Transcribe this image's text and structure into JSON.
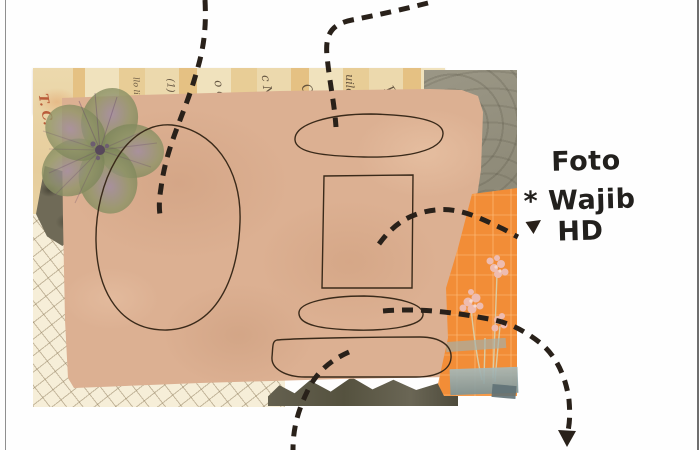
{
  "page": {
    "background": "#fefefe",
    "frame_line_color": "#8f8f8f"
  },
  "annotation": {
    "line1": "Foto",
    "line2": "* Wajib HD",
    "text_color": "#22201d"
  },
  "palette": {
    "kraft_paper": "#dcb092",
    "orange_paper": "#f28d37",
    "grid_paper": "#f6eed8",
    "damask_paper": "#96927f",
    "vintage_paper": "#ecd9ad",
    "dark_torn_paper": "#5c584a",
    "washi_tape": "#8fa5a8",
    "flower_olive": "#8e9465",
    "flower_purple": "#8a6f8e",
    "slot_outline": "#3a2a1a",
    "arrow": "#29211a"
  },
  "collage": {
    "print_fragments": [
      "llo liu",
      "(1)",
      "o a",
      "c N.",
      "Q",
      "uilo",
      "R",
      "L.",
      "T. C."
    ]
  },
  "photo_slots": [
    {
      "name": "large-oval-slot"
    },
    {
      "name": "top-pill-slot"
    },
    {
      "name": "rectangle-slot"
    },
    {
      "name": "small-oval-slot"
    },
    {
      "name": "bottom-pill-slot"
    }
  ],
  "arrows": [
    {
      "name": "arrow-top-left",
      "points_to": "large-oval-slot"
    },
    {
      "name": "arrow-top-right",
      "points_to": "top-pill-slot"
    },
    {
      "name": "arrow-to-foto-note",
      "points_to": "foto-annotation"
    },
    {
      "name": "arrow-bottom-right",
      "points_to": "offscreen-bottom-right"
    },
    {
      "name": "arrow-bottom-center",
      "points_to": "offscreen-bottom"
    }
  ]
}
